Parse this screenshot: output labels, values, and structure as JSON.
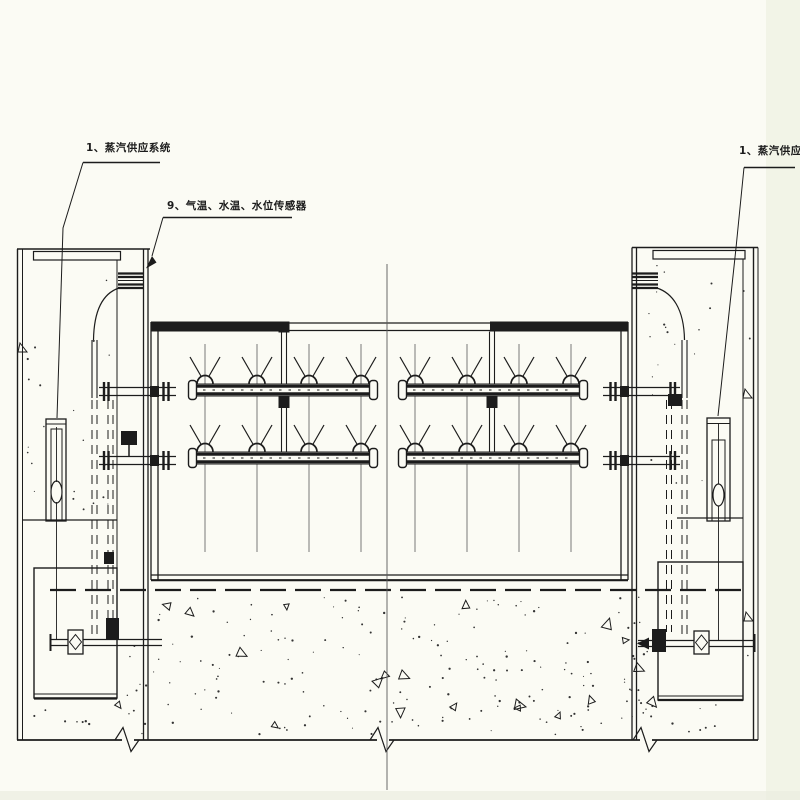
{
  "colors": {
    "background": "#fbfbf4",
    "ink": "#1c1c1c",
    "thin_line": "#5a5a5a",
    "scan_edge_right": "#eff1e3",
    "scan_edge_bottom": "#ebece0"
  },
  "annotations": {
    "steam_supply_left": {
      "text": "1、蒸汽供应系统"
    },
    "sensors": {
      "text": "9、气温、水温、水位传感器"
    },
    "steam_supply_right": {
      "text": "1、蒸汽供应系统"
    }
  }
}
